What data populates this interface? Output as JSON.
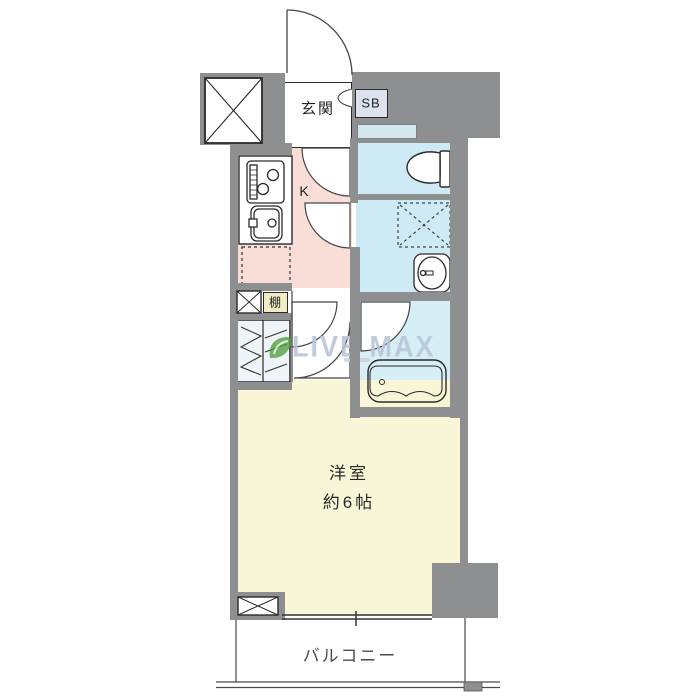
{
  "page": {
    "background": "#ffffff",
    "type": "apartment-floorplan"
  },
  "labels": {
    "entrance": "玄関",
    "shoe_box": "SB",
    "kitchen": "K",
    "shelf": "棚",
    "room_name": "洋室",
    "room_size": "約6帖",
    "balcony": "バルコニー"
  },
  "watermark": {
    "text": "LIVE MAX"
  },
  "colors": {
    "wall": "#8e8f91",
    "kitchen-floor": "#f8ded7",
    "wet-floor": "#cdeaf5",
    "bath-floor": "#d6eef6",
    "nook-floor": "#d5e7ee",
    "living-floor": "#f9f6d8",
    "shelf-fill": "#f1ecc4",
    "shoebox-fill": "#dde3ee",
    "closet-fill": "#eef4f7",
    "line": "#2b2b2b",
    "watermark-text": "#b9c5d8",
    "watermark-green": "#4f9e38"
  }
}
